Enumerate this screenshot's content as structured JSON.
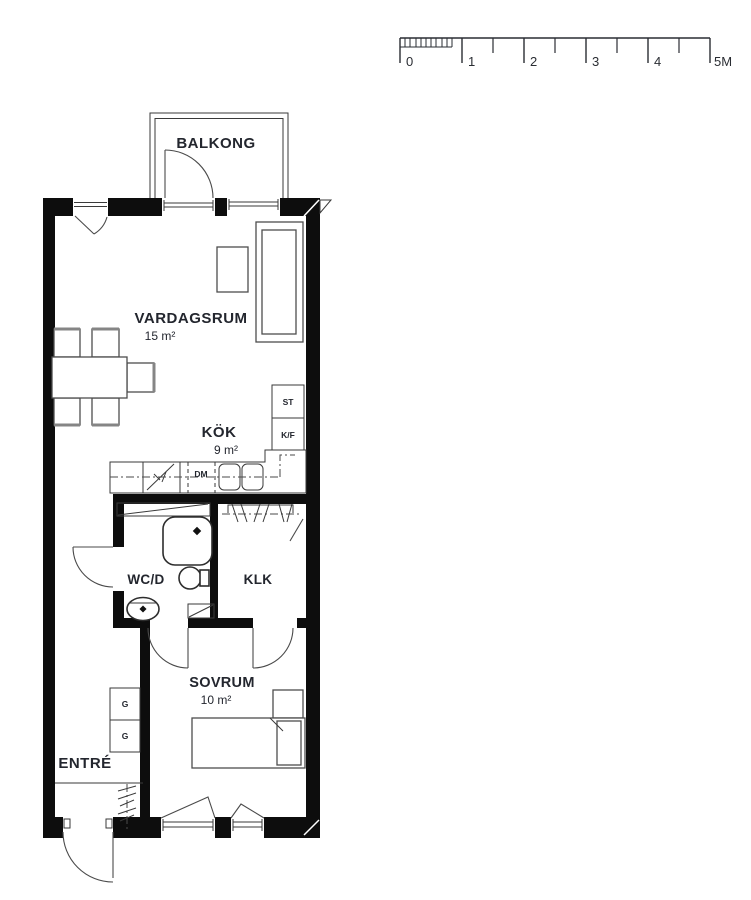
{
  "scale_bar": {
    "labels": [
      "0",
      "1",
      "2",
      "3",
      "4",
      "5M"
    ]
  },
  "rooms": {
    "balkong": {
      "name": "BALKONG"
    },
    "vardagsrum": {
      "name": "VARDAGSRUM",
      "area": "15 m²"
    },
    "kok": {
      "name": "KÖK",
      "area": "9 m²"
    },
    "wcd": {
      "name": "WC/D"
    },
    "klk": {
      "name": "KLK"
    },
    "sovrum": {
      "name": "SOVRUM",
      "area": "10 m²"
    },
    "entre": {
      "name": "ENTRÉ"
    }
  },
  "fixtures": {
    "pantry": "ST",
    "fridge_freezer": "K/F",
    "dishwasher": "DM",
    "wardrobe_1": "G",
    "wardrobe_2": "G"
  },
  "colors": {
    "wall": "#0d0d0d",
    "line": "#3a3a3a",
    "text": "#23262e",
    "background": "#ffffff"
  }
}
